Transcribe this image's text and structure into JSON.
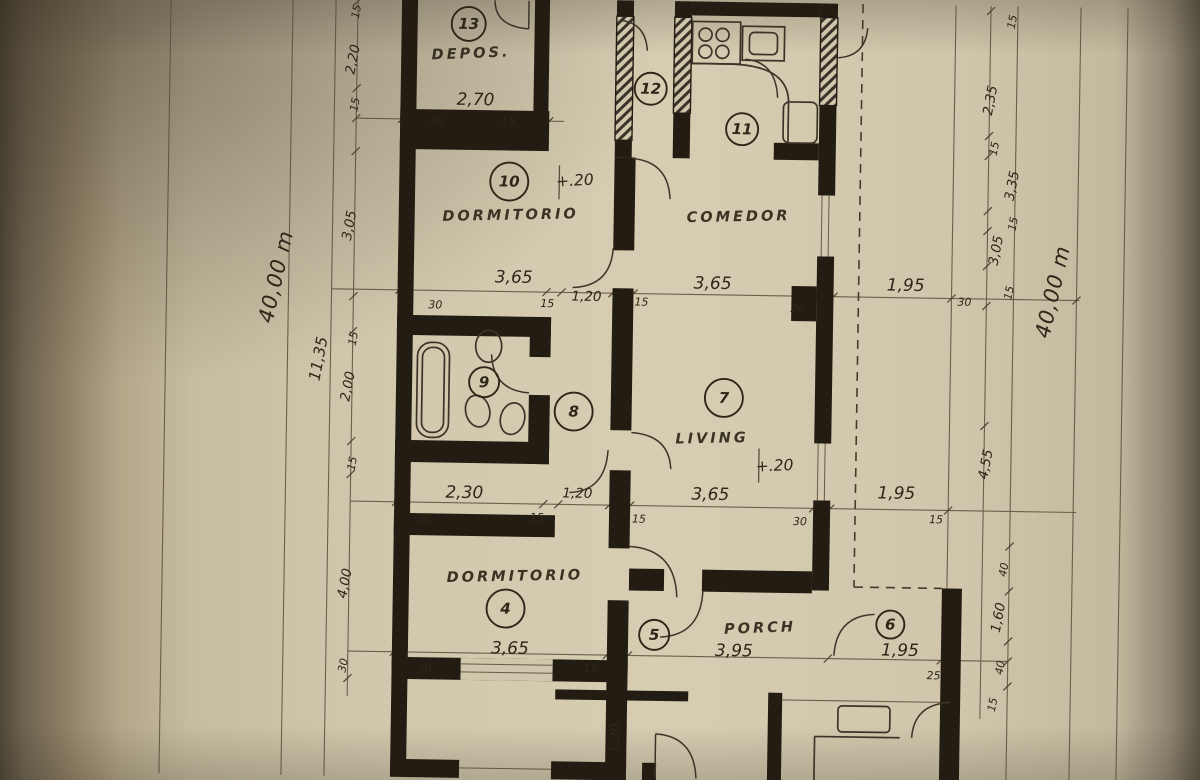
{
  "colors": {
    "paper": "#d4cbb0",
    "paper_edge": "#6e6350",
    "ink": "#231c12",
    "pencil": "#5a4e3c"
  },
  "rooms": {
    "depos": {
      "number": "13",
      "label": "DEPOS.",
      "width": "2,70"
    },
    "corridor": {
      "number": "12"
    },
    "kitchen": {
      "number": "11"
    },
    "comedor": {
      "label": "COMEDOR",
      "width": "3,65"
    },
    "dorm_upper": {
      "number": "10",
      "label": "DORMITORIO",
      "level": "+.20",
      "width": "3,65"
    },
    "bath": {
      "number": "9"
    },
    "hall": {
      "number": "8"
    },
    "living": {
      "number": "7",
      "label": "LIVING",
      "level": "+.20",
      "width": "3,65"
    },
    "dorm_lower": {
      "number": "4",
      "label": "DORMITORIO",
      "width": "3,65"
    },
    "porch": {
      "number": "5",
      "label": "PORCH",
      "width": "3,95"
    },
    "service": {
      "number": "6",
      "width": "1,95"
    }
  },
  "dim_rows": {
    "top": {
      "tick_a": "30",
      "tick_b": "15"
    },
    "upper": {
      "tick_a": "30",
      "tick_b": "15",
      "hall": "1,20",
      "tick_c": "15",
      "tick_d": "20",
      "side": "1,95",
      "tick_e": "30"
    },
    "middle": {
      "bath": "2,30",
      "tick_a": "30",
      "tick_b": "15",
      "hall": "1,20",
      "tick_c": "15",
      "tick_d": "30",
      "side": "1,95",
      "tick_e": "15"
    },
    "lower": {
      "tick_a": "30",
      "tick_b": "15",
      "tick_c": "25"
    },
    "bottom": {
      "door": "1,20"
    }
  },
  "margins": {
    "left": {
      "total": "40,00 m",
      "offset": "11,35",
      "chain": [
        "15",
        "2,20",
        "15",
        "3,05",
        "15",
        "2,00",
        "15",
        "4,00",
        "30"
      ]
    },
    "right": {
      "total": "40,00 m",
      "chain": [
        "15",
        "2,35",
        "15",
        "3,35",
        "15",
        "3,05",
        "15",
        "4,55",
        "40",
        "1,60",
        "40",
        "15"
      ]
    }
  }
}
